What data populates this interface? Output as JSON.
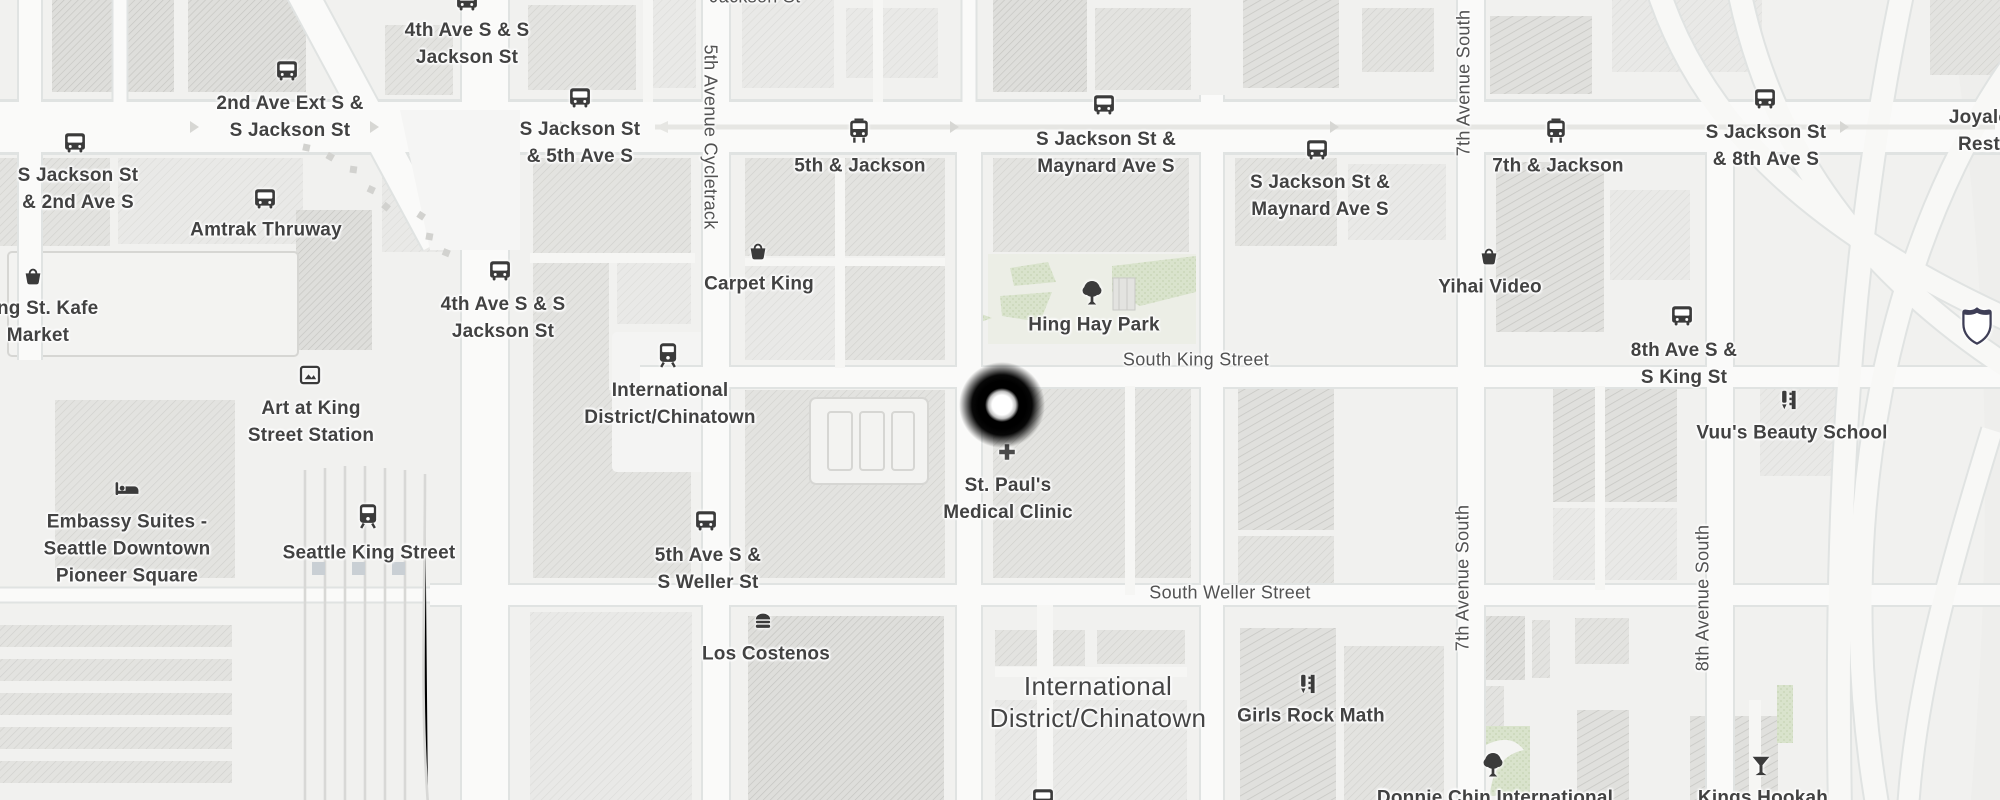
{
  "map": {
    "colors": {
      "background": "#f1f1ef",
      "road": "#fafaf9",
      "road_casing": "#e1e4e3",
      "block_light": "#e9e9e7",
      "block_mid": "#e3e3e0",
      "block_dark": "#dededb",
      "park_green": "#d9e3cc",
      "rail": "#d8d8d6",
      "label_text": "#424242",
      "street_text": "#525252",
      "icon": "#3b3b3b",
      "shield_border": "#3e3e56",
      "pin_outer": "#000000",
      "pin_inner": "#ffffff"
    },
    "pin": {
      "x": 1002,
      "y": 405
    },
    "labels": [
      {
        "name": "street-jackson-st-top",
        "cls": "street",
        "x": 755,
        "y": -3,
        "lines": [
          "Jackson St"
        ]
      },
      {
        "name": "stop-4th-ave-s-jackson-st-north",
        "x": 467,
        "y": 44,
        "lines": [
          "4th Ave S & S",
          "Jackson St"
        ],
        "icon": {
          "type": "bus",
          "x": 467,
          "y": 1
        }
      },
      {
        "name": "stop-2nd-ave-ext-s-jackson-st",
        "x": 290,
        "y": 117,
        "lines": [
          "2nd Ave Ext S &",
          "S Jackson St"
        ],
        "icon": {
          "type": "bus",
          "x": 287,
          "y": 71
        }
      },
      {
        "name": "stop-s-jackson-st-2nd-ave-s",
        "x": 78,
        "y": 189,
        "lines": [
          "S Jackson St",
          "& 2nd Ave S"
        ],
        "icon": {
          "type": "bus",
          "x": 75,
          "y": 143
        }
      },
      {
        "name": "stop-amtrak-thruway",
        "x": 266,
        "y": 230,
        "lines": [
          "Amtrak Thruway"
        ],
        "icon": {
          "type": "bus",
          "x": 265,
          "y": 199
        }
      },
      {
        "name": "stop-s-jackson-st-5th-ave-s",
        "x": 580,
        "y": 143,
        "lines": [
          "S Jackson St",
          "& 5th Ave S"
        ],
        "icon": {
          "type": "bus",
          "x": 580,
          "y": 98
        }
      },
      {
        "name": "stop-4th-ave-s-jackson-st-south",
        "x": 503,
        "y": 318,
        "lines": [
          "4th Ave S & S",
          "Jackson St"
        ],
        "icon": {
          "type": "bus",
          "x": 500,
          "y": 271
        }
      },
      {
        "name": "street-5th-avenue-cycletrack",
        "cls": "street",
        "rot": "cw",
        "x": 710,
        "y": 137,
        "lines": [
          "5th Avenue Cycletrack"
        ]
      },
      {
        "name": "stop-5th-and-jackson",
        "x": 860,
        "y": 166,
        "lines": [
          "5th & Jackson"
        ],
        "icon": {
          "type": "tram",
          "x": 859,
          "y": 131
        }
      },
      {
        "name": "poi-carpet-king",
        "x": 759,
        "y": 284,
        "lines": [
          "Carpet King"
        ],
        "icon": {
          "type": "basket",
          "x": 758,
          "y": 251
        }
      },
      {
        "name": "stop-s-jackson-maynard-west",
        "x": 1106,
        "y": 153,
        "lines": [
          "S Jackson St &",
          "Maynard Ave S"
        ],
        "icon": {
          "type": "bus",
          "x": 1104,
          "y": 105
        }
      },
      {
        "name": "stop-s-jackson-maynard-east",
        "x": 1320,
        "y": 196,
        "lines": [
          "S Jackson St &",
          "Maynard Ave S"
        ],
        "icon": {
          "type": "bus",
          "x": 1317,
          "y": 150
        }
      },
      {
        "name": "poi-hing-hay-park",
        "x": 1094,
        "y": 325,
        "lines": [
          "Hing Hay Park"
        ],
        "icon": {
          "type": "tree",
          "x": 1092,
          "y": 293
        }
      },
      {
        "name": "street-south-king-street",
        "cls": "street",
        "x": 1196,
        "y": 360,
        "lines": [
          "South King Street"
        ]
      },
      {
        "name": "street-7th-avenue-south-north",
        "cls": "street",
        "rot": "ccw",
        "x": 1464,
        "y": 83,
        "lines": [
          "7th Avenue South"
        ]
      },
      {
        "name": "stop-7th-and-jackson",
        "x": 1558,
        "y": 166,
        "lines": [
          "7th & Jackson"
        ],
        "icon": {
          "type": "tram",
          "x": 1556,
          "y": 131
        }
      },
      {
        "name": "stop-s-jackson-st-8th-ave-s",
        "x": 1766,
        "y": 146,
        "lines": [
          "S Jackson St",
          "& 8th Ave S"
        ],
        "icon": {
          "type": "bus",
          "x": 1765,
          "y": 99
        }
      },
      {
        "name": "poi-joyale-restaurant",
        "x": 1979,
        "y": 131,
        "lines": [
          "Joyale",
          "Rest"
        ]
      },
      {
        "name": "highway-shield",
        "x": 1977,
        "y": 326,
        "icon": {
          "type": "shield",
          "x": 1977,
          "y": 326
        }
      },
      {
        "name": "poi-yihai-video",
        "x": 1490,
        "y": 287,
        "lines": [
          "Yihai Video"
        ],
        "icon": {
          "type": "basket",
          "x": 1489,
          "y": 256
        }
      },
      {
        "name": "stop-8th-ave-s-s-king-st",
        "x": 1684,
        "y": 364,
        "lines": [
          "8th Ave S &",
          "S King St"
        ],
        "icon": {
          "type": "bus",
          "x": 1682,
          "y": 316
        }
      },
      {
        "name": "poi-vuus-beauty-school",
        "x": 1792,
        "y": 433,
        "lines": [
          "Vuu's Beauty School"
        ],
        "icon": {
          "type": "beauty",
          "x": 1789,
          "y": 400
        }
      },
      {
        "name": "poi-st-pauls-medical-clinic",
        "x": 1008,
        "y": 499,
        "lines": [
          "St. Paul's",
          "Medical Clinic"
        ],
        "icon": {
          "type": "cross",
          "x": 1007,
          "y": 452
        }
      },
      {
        "name": "street-south-weller-street",
        "cls": "street",
        "x": 1230,
        "y": 593,
        "lines": [
          "South Weller Street"
        ]
      },
      {
        "name": "poi-king-st-kafe-market",
        "x": 38,
        "y": 322,
        "lines": [
          "King St. Kafe",
          "Market"
        ],
        "icon": {
          "type": "basket",
          "x": 33,
          "y": 276
        }
      },
      {
        "name": "poi-art-at-king-street-station",
        "x": 311,
        "y": 422,
        "lines": [
          "Art at King",
          "Street Station"
        ],
        "icon": {
          "type": "frame",
          "x": 310,
          "y": 375
        }
      },
      {
        "name": "poi-embassy-suites",
        "x": 127,
        "y": 549,
        "lines": [
          "Embassy Suites -",
          "Seattle Downtown",
          "Pioneer Square"
        ],
        "icon": {
          "type": "bed",
          "x": 127,
          "y": 489
        }
      },
      {
        "name": "station-seattle-king-street",
        "x": 369,
        "y": 553,
        "lines": [
          "Seattle King Street"
        ],
        "icon": {
          "type": "train",
          "x": 368,
          "y": 516
        }
      },
      {
        "name": "station-international-district",
        "x": 670,
        "y": 404,
        "lines": [
          "International",
          "District/Chinatown"
        ],
        "icon": {
          "type": "train",
          "x": 668,
          "y": 355
        }
      },
      {
        "name": "stop-5th-ave-s-s-weller-st",
        "x": 708,
        "y": 569,
        "lines": [
          "5th Ave S &",
          "S Weller St"
        ],
        "icon": {
          "type": "bus",
          "x": 706,
          "y": 521
        }
      },
      {
        "name": "poi-los-costenos",
        "x": 766,
        "y": 654,
        "lines": [
          "Los Costenos"
        ],
        "icon": {
          "type": "burger",
          "x": 763,
          "y": 621
        }
      },
      {
        "name": "neighborhood-international-district",
        "cls": "big",
        "x": 1098,
        "y": 702,
        "lines": [
          "International",
          "District/Chinatown"
        ]
      },
      {
        "name": "poi-girls-rock-math",
        "x": 1311,
        "y": 716,
        "lines": [
          "Girls Rock Math"
        ],
        "icon": {
          "type": "beauty",
          "x": 1308,
          "y": 684
        }
      },
      {
        "name": "street-7th-avenue-south-south",
        "cls": "street",
        "rot": "ccw",
        "x": 1463,
        "y": 578,
        "lines": [
          "7th Avenue South"
        ]
      },
      {
        "name": "street-8th-avenue-south",
        "cls": "street",
        "rot": "ccw",
        "x": 1703,
        "y": 598,
        "lines": [
          "8th Avenue South"
        ]
      },
      {
        "name": "poi-donnie-chin-international",
        "x": 1495,
        "y": 798,
        "lines": [
          "Donnie Chin International"
        ],
        "icon": {
          "type": "tree",
          "x": 1493,
          "y": 765
        }
      },
      {
        "name": "poi-kings-hookah",
        "x": 1763,
        "y": 798,
        "lines": [
          "Kings Hookah"
        ],
        "icon": {
          "type": "martini",
          "x": 1761,
          "y": 766
        }
      },
      {
        "name": "stop-bottom-partial",
        "x": 1043,
        "y": 799,
        "icon": {
          "type": "bus",
          "x": 1043,
          "y": 799
        }
      }
    ]
  }
}
